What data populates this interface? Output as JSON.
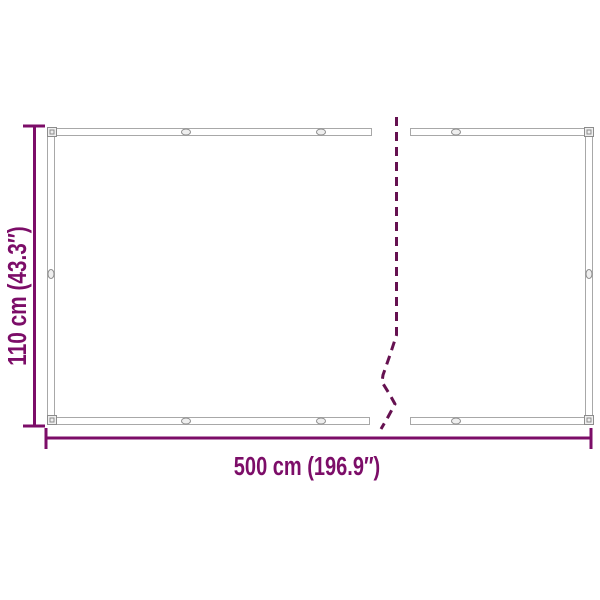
{
  "diagram": {
    "type": "product-dimension-diagram",
    "height_label": "110 cm (43.3″)",
    "width_label": "500 cm (196.9″)"
  },
  "colors": {
    "accent": "#7c0d68",
    "break_line": "#651150",
    "frame_line": "#a8a8a8",
    "frame_detail": "#8c8c8c",
    "frame_fill": "#efefef",
    "background": "#ffffff"
  }
}
